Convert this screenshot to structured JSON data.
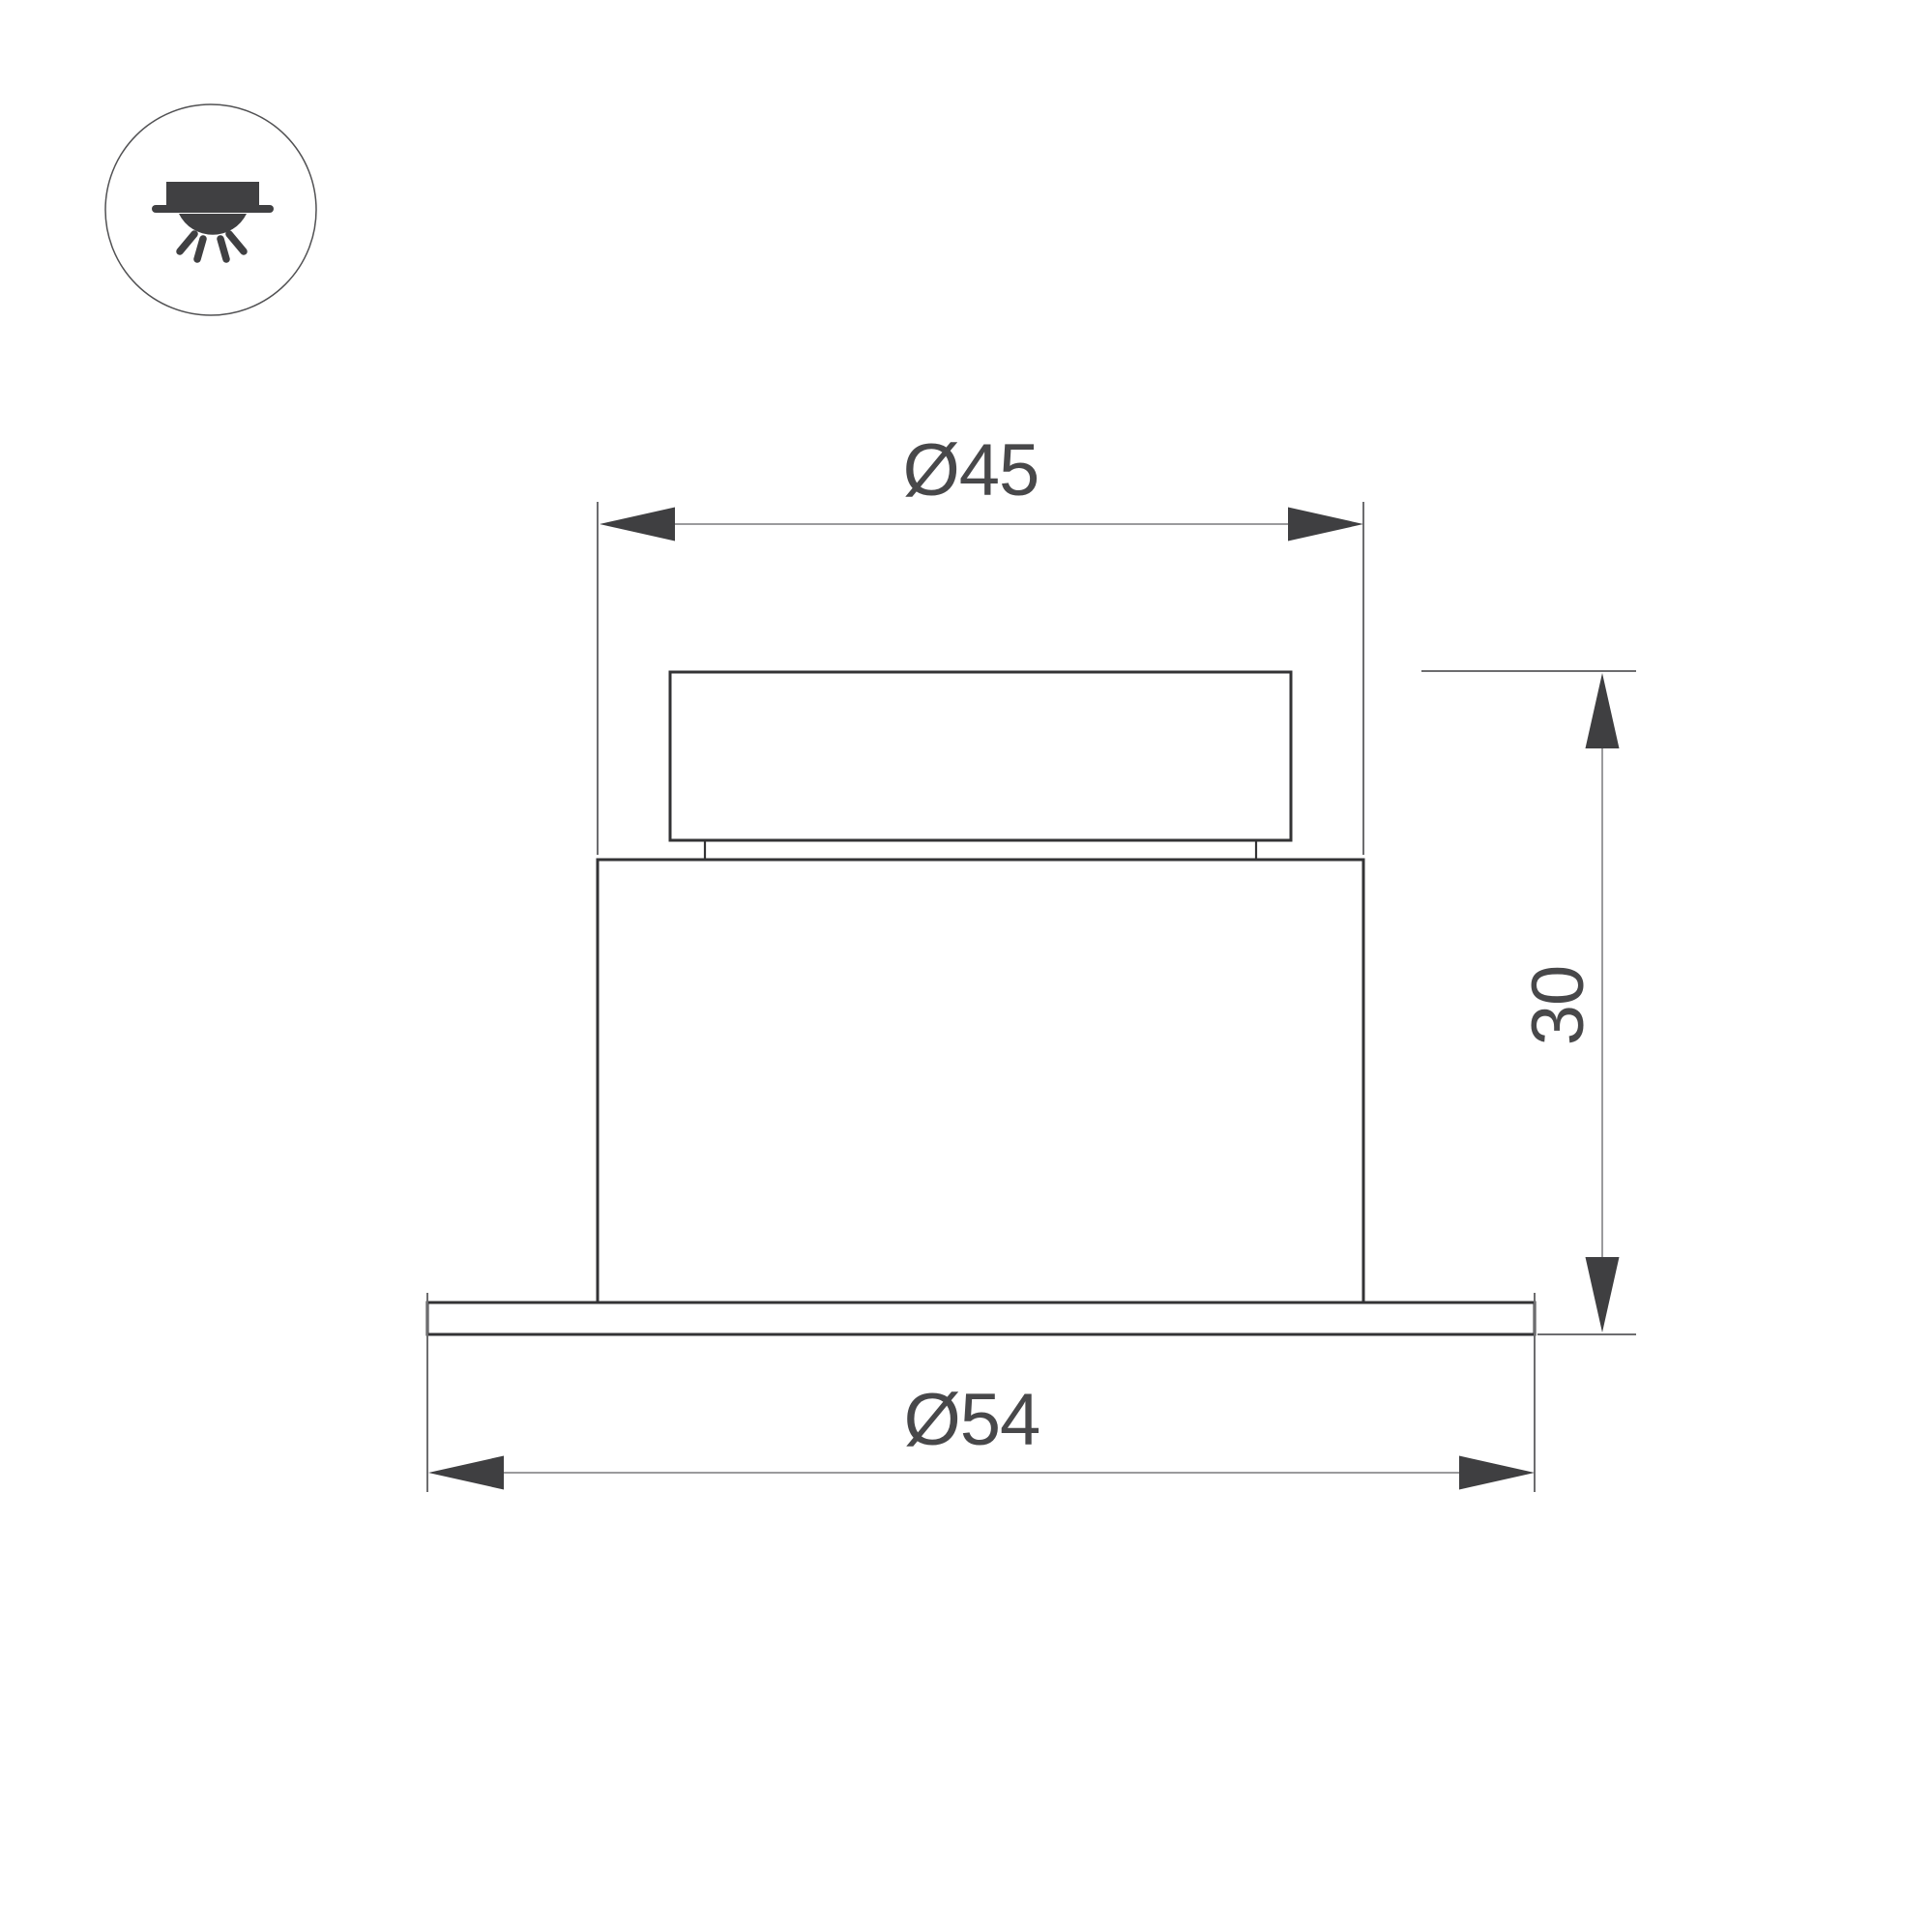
{
  "page": {
    "background": "#ffffff"
  },
  "legend_icon": {
    "name": "recessed-downlight-icon",
    "meaning": "recessed ceiling light shining downward"
  },
  "drawing": {
    "type": "technical dimension drawing",
    "view": "side view of recessed spot luminaire",
    "labels": {
      "top_diameter": "Ø45",
      "flange_diameter": "Ø54",
      "height": "30"
    },
    "values": {
      "top_diameter": 45,
      "flange_diameter": 54,
      "height": 30
    },
    "colors": {
      "object_line": "#333335",
      "extension_line": "#6d6d6f",
      "dimension_line": "#9b9b9d",
      "arrowhead": "#3f3f41",
      "label_text": "#48484a",
      "icon": "#404042",
      "background": "#ffffff"
    }
  }
}
